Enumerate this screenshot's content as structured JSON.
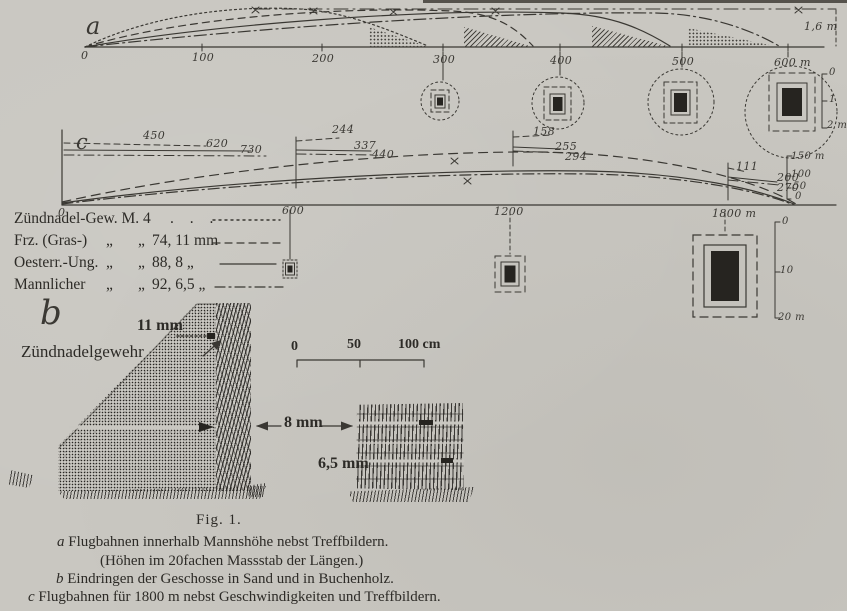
{
  "colors": {
    "paper": "#c9c7c1",
    "ink": "#3a3833",
    "dark_fill": "#262420"
  },
  "diagram_a": {
    "label": "a",
    "axis_ticks": [
      "0",
      "100",
      "200",
      "300",
      "400",
      "500",
      "600 m"
    ],
    "man_height_label": "1,6 m",
    "target_scale_labels": [
      "0",
      "1",
      "2 m"
    ]
  },
  "diagram_c": {
    "label": "c",
    "axis_ticks": [
      "0",
      "600",
      "1200",
      "1800 m"
    ],
    "velocity_labels": {
      "at_0": [
        "450",
        "620",
        "730"
      ],
      "at_600": [
        "244",
        "337",
        "440"
      ],
      "at_1200": [
        "158",
        "255",
        "294"
      ],
      "at_1800": [
        "111",
        "200",
        "270"
      ]
    },
    "ordinate_scale_labels": [
      "150 m",
      "100",
      "50",
      "0"
    ],
    "drop_scale_labels": [
      "0",
      "10",
      "20 m"
    ]
  },
  "legend": {
    "rows": [
      {
        "name": "Zündnadel-Gew. M. 4",
        "mark1": "",
        "mark2": "",
        "value": ". . .",
        "line_style": "dotted"
      },
      {
        "name": "Frz. (Gras-)",
        "mark1": "„",
        "mark2": "„",
        "value": "74, 11 mm",
        "line_style": "dashed"
      },
      {
        "name": "Oesterr.-Ung.",
        "mark1": "„",
        "mark2": "„",
        "value": "88, 8 „",
        "line_style": "solid"
      },
      {
        "name": "Mannlicher",
        "mark1": "„",
        "mark2": "„",
        "value": "92, 6,5 „",
        "line_style": "dash-dot"
      }
    ]
  },
  "diagram_b": {
    "label": "b",
    "caliber_11": "11 mm",
    "rifle_label": "Zündnadelgewehr",
    "caliber_8": "8 mm",
    "caliber_65": "6,5 mm",
    "scale_labels": [
      "0",
      "50",
      "100 cm"
    ]
  },
  "caption": {
    "fig_label": "Fig. 1.",
    "lines": [
      {
        "marker": "a",
        "text": "Flugbahnen innerhalb Mannshöhe nebst Treffbildern."
      },
      {
        "marker": "",
        "text": "(Höhen im 20fachen Massstab der Längen.)"
      },
      {
        "marker": "b",
        "text": "Eindringen der Geschosse in Sand und in Buchenholz."
      },
      {
        "marker": "c",
        "text": "Flugbahnen für 1800 m nebst Geschwindigkeiten und Treffbildern."
      }
    ]
  }
}
